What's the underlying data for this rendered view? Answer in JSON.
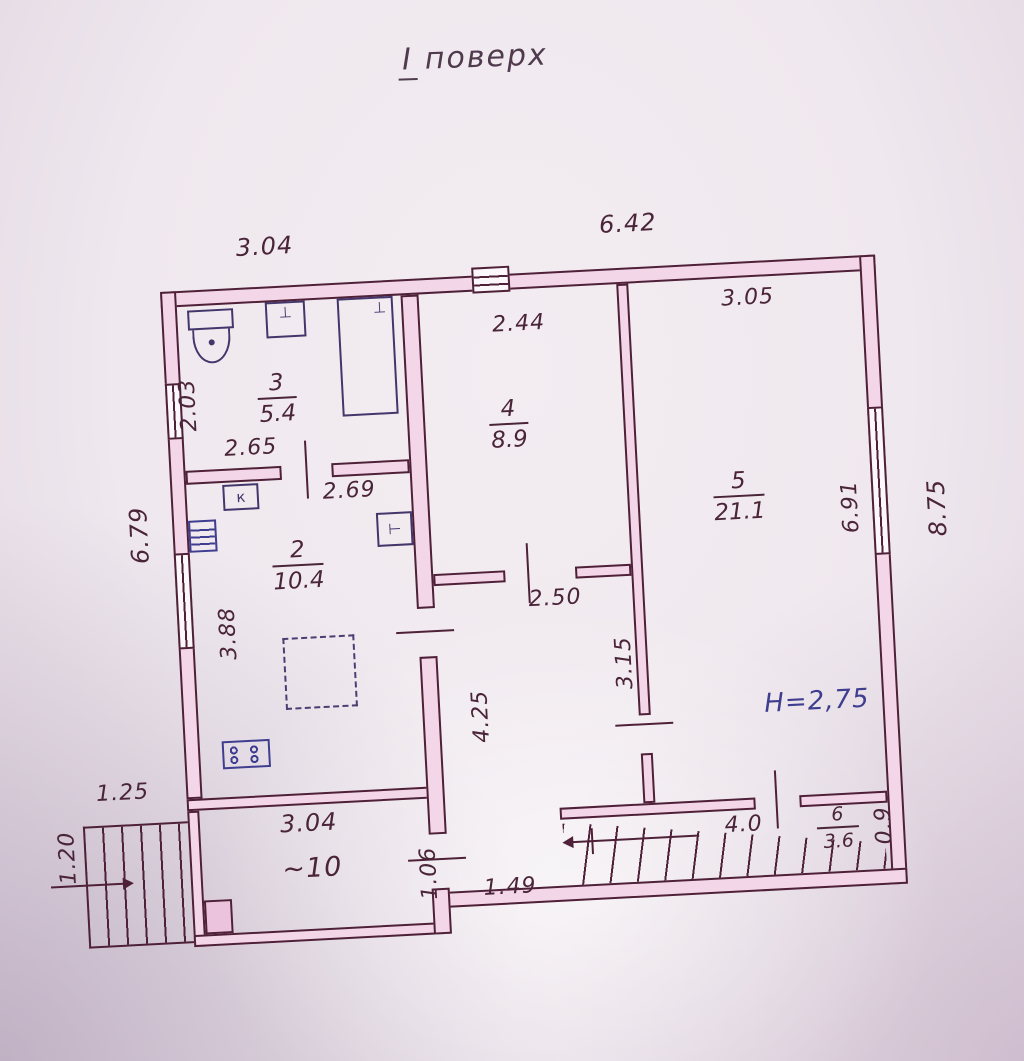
{
  "title": {
    "numeral": "І",
    "word": "поверх"
  },
  "colors": {
    "wall_fill": "#f3d6e7",
    "ink": "#4e2138",
    "pen_blue": "#3f3d8f",
    "paper": "#efe8ee"
  },
  "plan": {
    "rooms": {
      "r3": {
        "number": "3",
        "area": "5.4"
      },
      "r2": {
        "number": "2",
        "area": "10.4"
      },
      "r4": {
        "number": "4",
        "area": "8.9"
      },
      "r5": {
        "number": "5",
        "area": "21.1"
      },
      "r6": {
        "number": "6",
        "area": "3.6"
      },
      "r10": {
        "label": "~10"
      }
    },
    "dims": {
      "top_left": "3.04",
      "top_right": "6.42",
      "room4_top": "2.44",
      "room5_top": "3.05",
      "room3_left": "2.03",
      "room3_bottom": "2.65",
      "room2_top": "2.69",
      "left_outer": "6.79",
      "room2_left": "3.88",
      "room5_right": "6.91",
      "right_outer": "8.75",
      "hall_top": "2.50",
      "hall_right": "3.15",
      "hall_left": "4.25",
      "porch_top": "1.25",
      "porch_left": "1.20",
      "room10_top": "3.04",
      "room10_right": "1.06",
      "hall_bottom": "1.49",
      "stairs_top": "4.0",
      "stairs_right": "0.9"
    },
    "annotations": {
      "ceiling_height": "H=2,75"
    },
    "fixtures": {
      "k_label": "к",
      "vent_label": "⊥",
      "boiler_label": "⊥",
      "meter_label": "⊢"
    }
  }
}
